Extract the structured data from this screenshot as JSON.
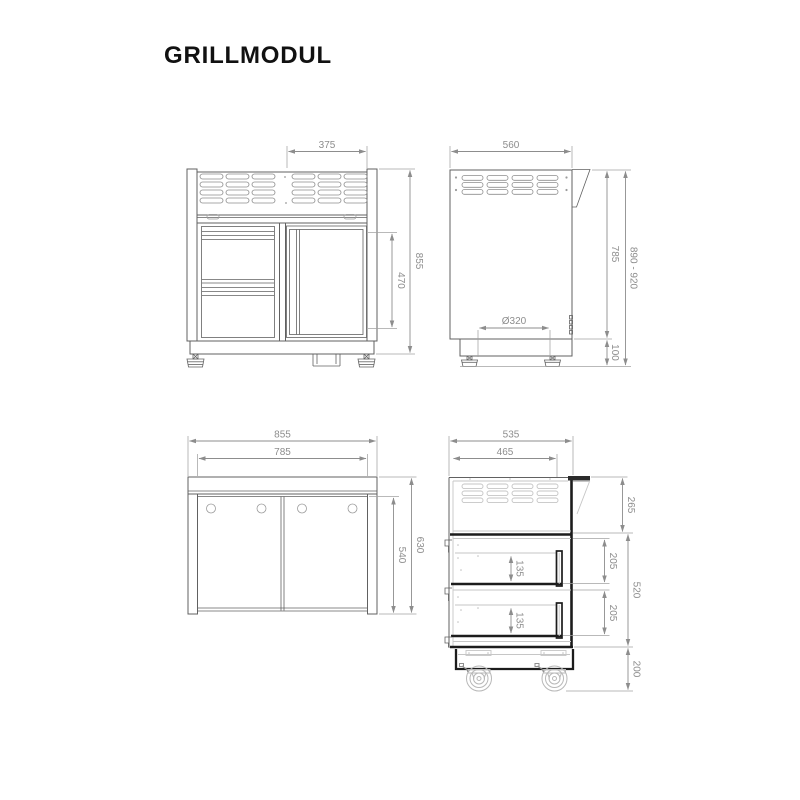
{
  "title": "GRILLMODUL",
  "colors": {
    "ink": "#616161",
    "dim_gray": "#8d8d8d",
    "section_black": "#1c1c1c",
    "light_gray": "#c5c5c5"
  },
  "views": {
    "front": {
      "label": "front-view",
      "dims": {
        "burner_width": "375",
        "door_height": "470",
        "total_height": "855"
      }
    },
    "side": {
      "label": "side-view",
      "dims": {
        "depth": "560",
        "body_height": "785",
        "total_height_range": "890 - 920",
        "plinth_height": "100",
        "kettle_diameter": "Ø320"
      }
    },
    "back": {
      "label": "back-view",
      "dims": {
        "outer_width": "855",
        "inner_width": "785",
        "outer_height": "630",
        "inner_height": "540"
      }
    },
    "section": {
      "label": "section-view",
      "dims": {
        "depth": "535",
        "inner_depth": "465",
        "top_section": "265",
        "drawer_bay_top": "205",
        "drawer_bay_bottom": "205",
        "drawer_inner_top": "135",
        "drawer_inner_bottom": "135",
        "body_height": "520",
        "caster_height": "200"
      }
    }
  }
}
